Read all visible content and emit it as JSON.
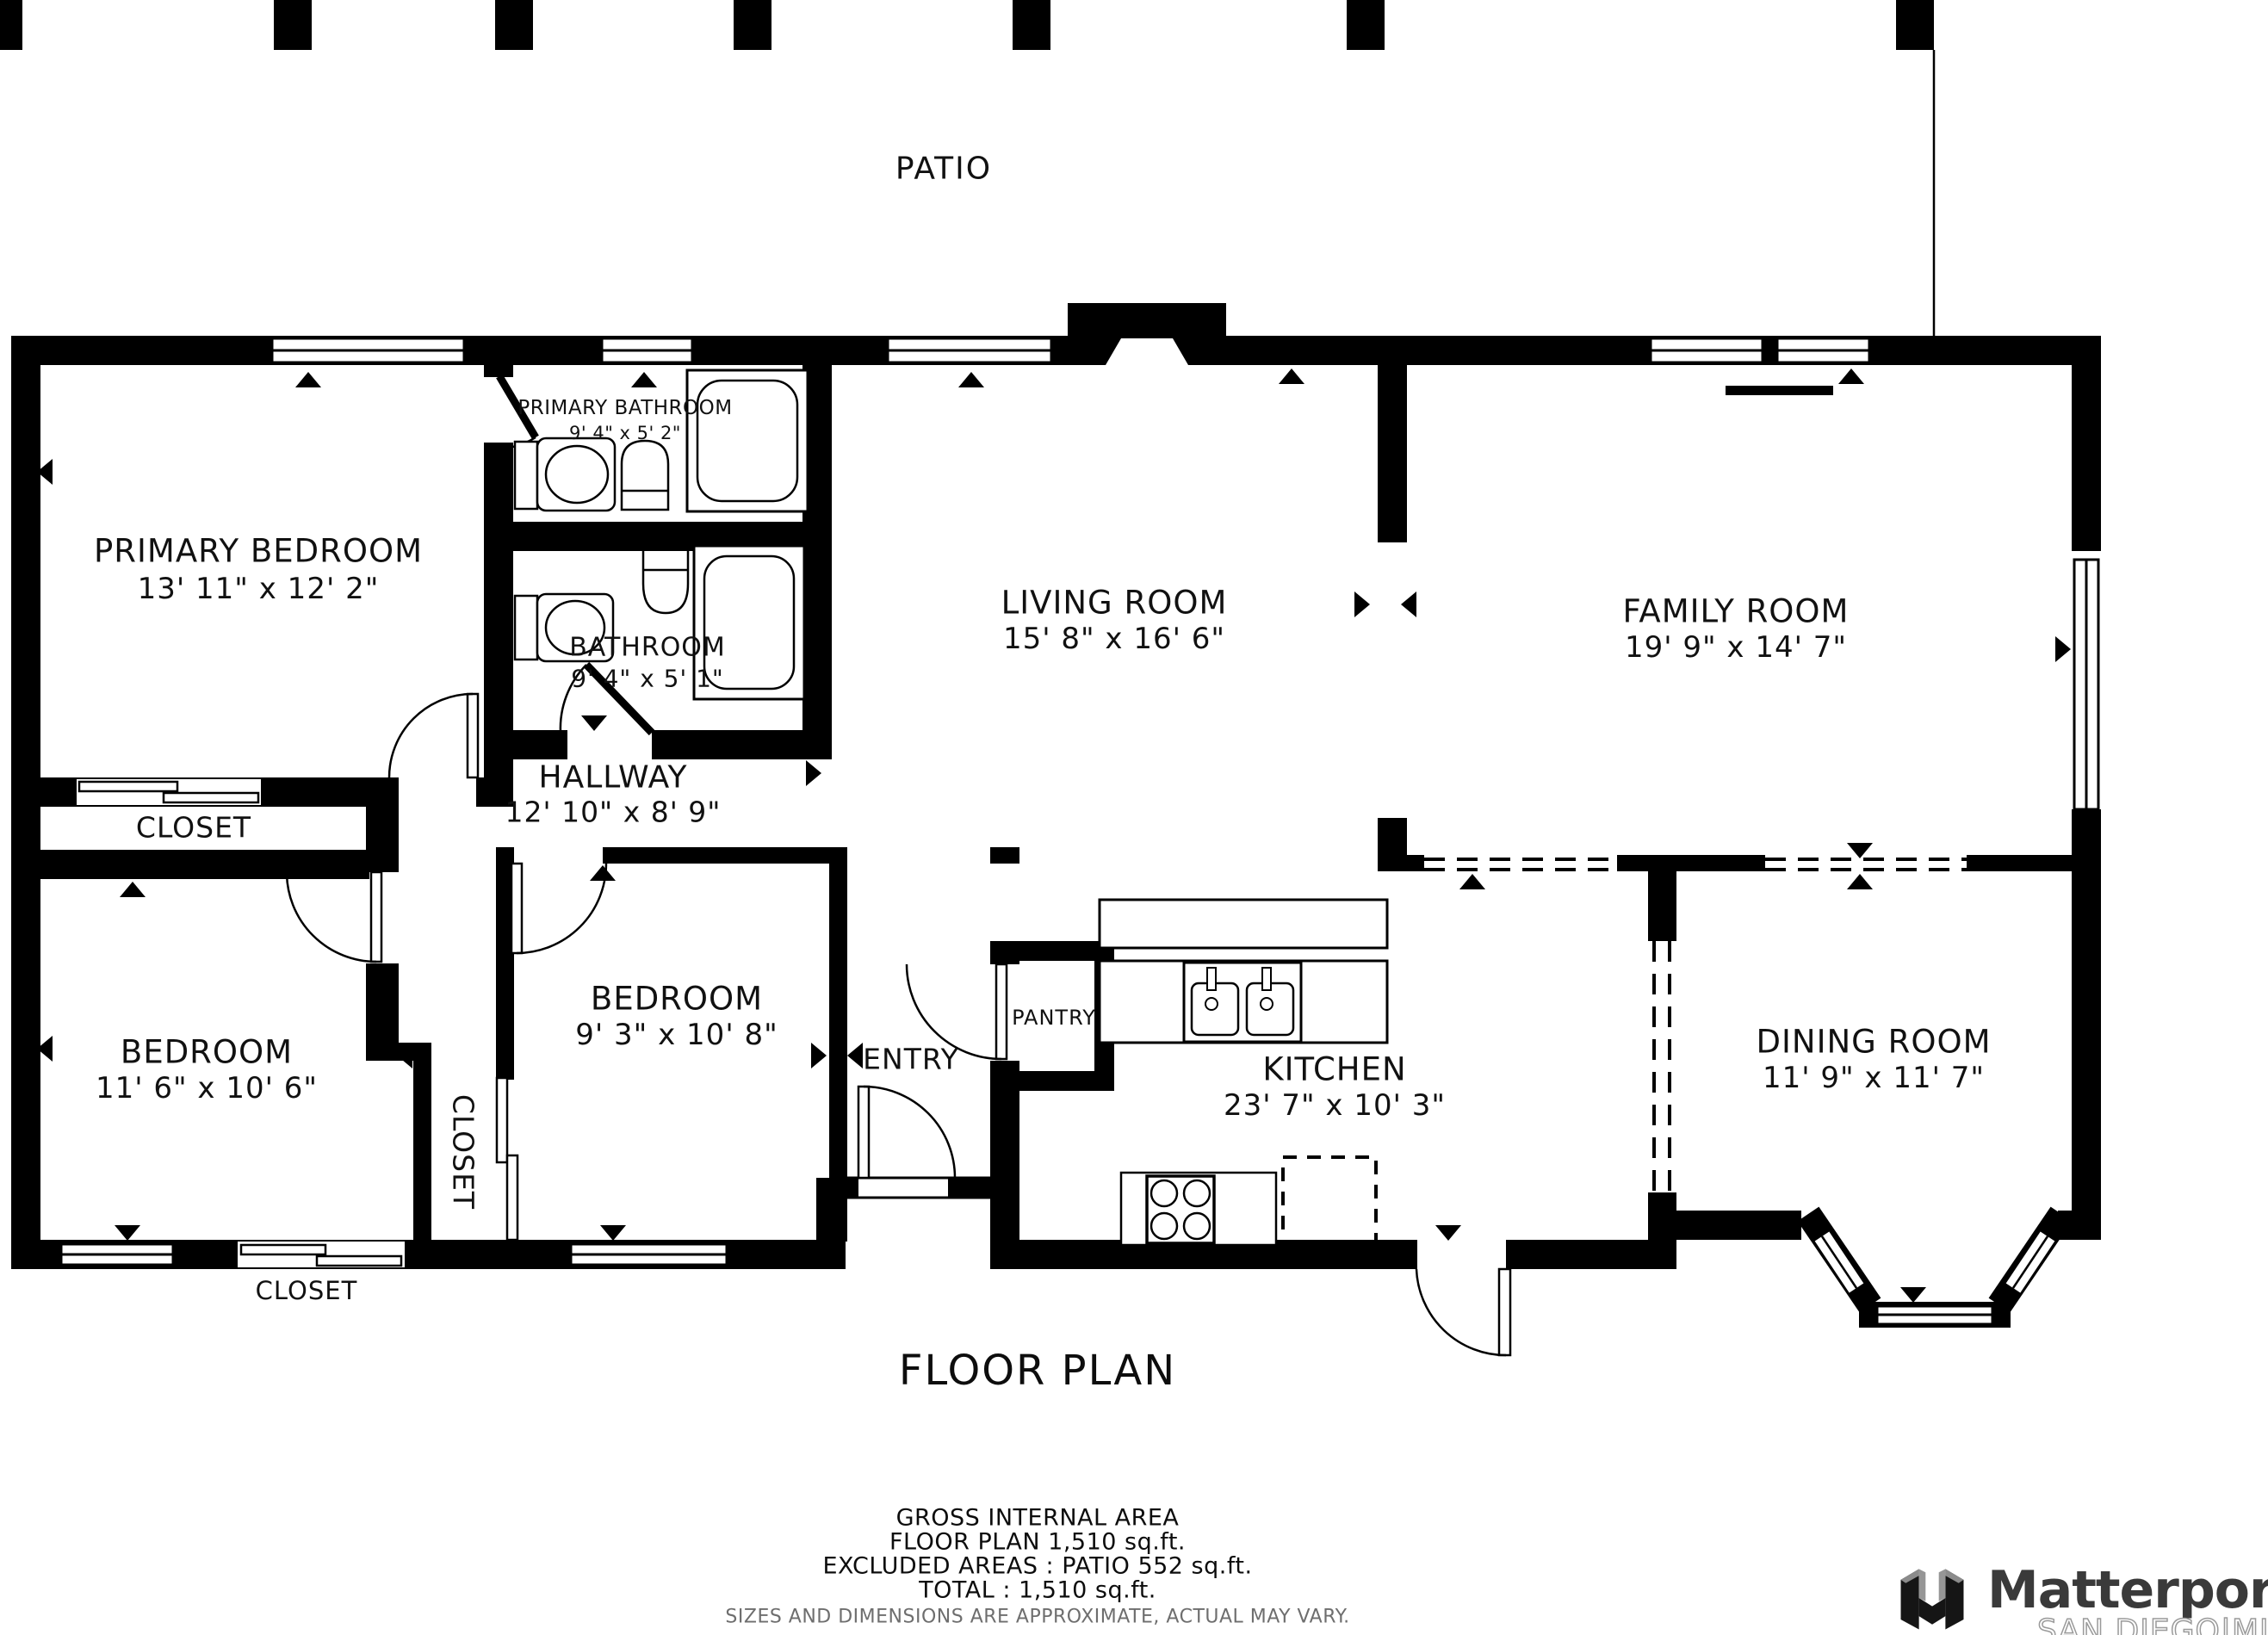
{
  "patio": {
    "label": "PATIO"
  },
  "rooms": {
    "primary_bedroom": {
      "name": "PRIMARY BEDROOM",
      "dims": "13' 11\" x 12' 2\""
    },
    "primary_bathroom": {
      "name": "PRIMARY BATHROOM",
      "dims": "9' 4\" x 5' 2\""
    },
    "bathroom": {
      "name": "BATHROOM",
      "dims": "9' 4\" x 5' 1\""
    },
    "living_room": {
      "name": "LIVING ROOM",
      "dims": "15' 8\" x 16' 6\""
    },
    "family_room": {
      "name": "FAMILY ROOM",
      "dims": "19' 9\" x 14' 7\""
    },
    "hallway": {
      "name": "HALLWAY",
      "dims": "12' 10\" x 8' 9\""
    },
    "bedroom_left": {
      "name": "BEDROOM",
      "dims": "11' 6\" x 10' 6\""
    },
    "bedroom_middle": {
      "name": "BEDROOM",
      "dims": "9' 3\" x 10' 8\""
    },
    "kitchen": {
      "name": "KITCHEN",
      "dims": "23' 7\" x 10' 3\""
    },
    "dining_room": {
      "name": "DINING ROOM",
      "dims": "11' 9\" x 11' 7\""
    },
    "entry": {
      "name": "ENTRY"
    },
    "pantry": {
      "name": "PANTRY"
    },
    "closet_primary": {
      "name": "CLOSET"
    },
    "closet_side": {
      "name": "CLOSET"
    },
    "closet_bottom": {
      "name": "CLOSET"
    }
  },
  "footer": {
    "title": "FLOOR PLAN",
    "area_heading": "GROSS INTERNAL AREA",
    "area_line1": "FLOOR PLAN 1,510 sq.ft.",
    "area_line2": "EXCLUDED AREAS :  PATIO 552 sq.ft.",
    "area_line3": "TOTAL :  1,510 sq.ft.",
    "disclaimer": "SIZES AND DIMENSIONS ARE APPROXIMATE, ACTUAL MAY VARY."
  },
  "branding": {
    "logo": "Matterport",
    "sub": "SAN DIEGO|MLS"
  },
  "colors": {
    "wall": "#000000",
    "background": "#ffffff",
    "disclaimer_text": "#6e6e6e",
    "brand_text": "#3a3a3a",
    "brand_sub_outline": "#9a9a9a"
  }
}
